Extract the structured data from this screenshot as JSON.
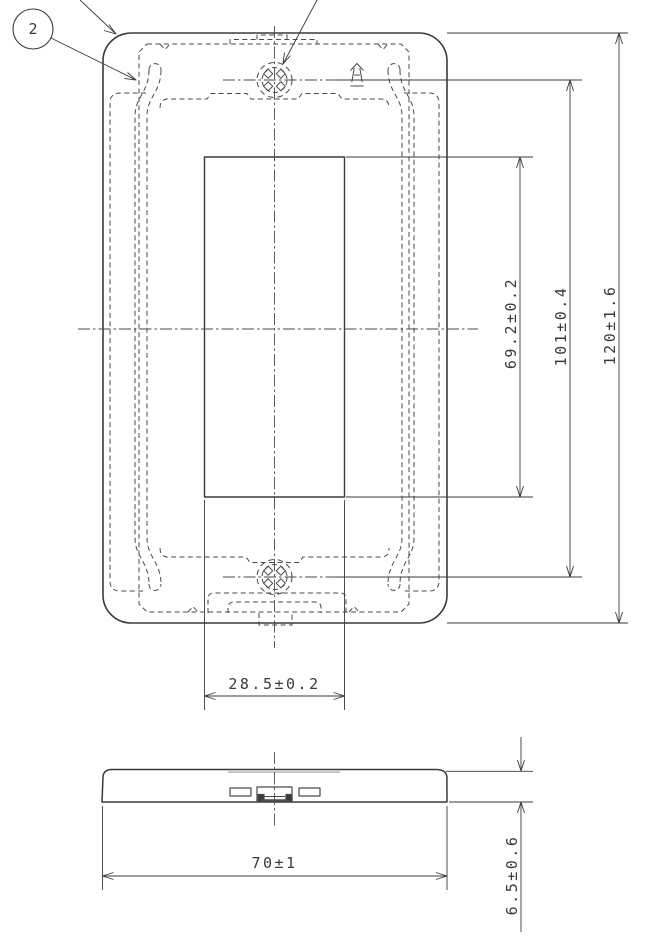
{
  "drawing": {
    "balloon": {
      "label": "2"
    },
    "front_view": {
      "dim_window_height": "69.2±0.2",
      "dim_screw_pitch": "101±0.4",
      "dim_plate_height": "120±1.6",
      "dim_window_width": "28.5±0.2"
    },
    "side_view": {
      "dim_plate_width": "70±1",
      "dim_plate_thickness": "6.5±0.6"
    },
    "line_color": "#3a3a3a"
  }
}
